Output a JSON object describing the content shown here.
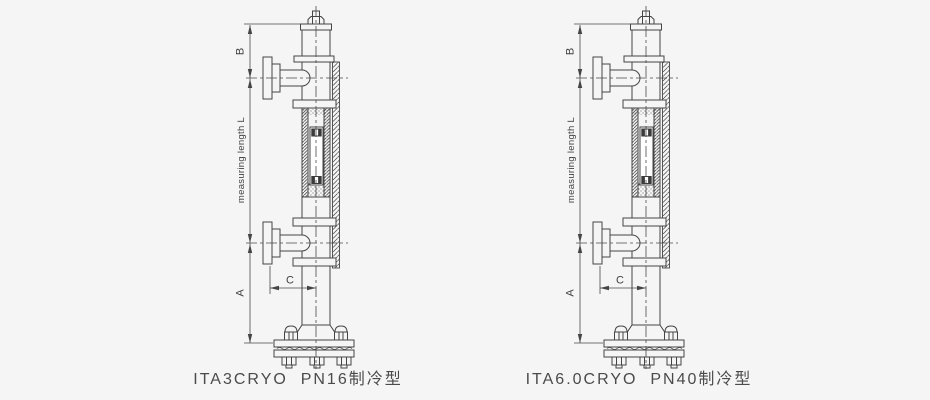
{
  "colors": {
    "background": "#f5f5f6",
    "line": "#454545",
    "caption_text": "#4b4b4b"
  },
  "dimension_labels": {
    "b": "B",
    "measuring_length": "measuring length L",
    "a": "A",
    "c": "C"
  },
  "diagrams": [
    {
      "caption": "ITA3CRYO  PN16制冷型"
    },
    {
      "caption": "ITA6.0CRYO  PN40制冷型"
    }
  ]
}
